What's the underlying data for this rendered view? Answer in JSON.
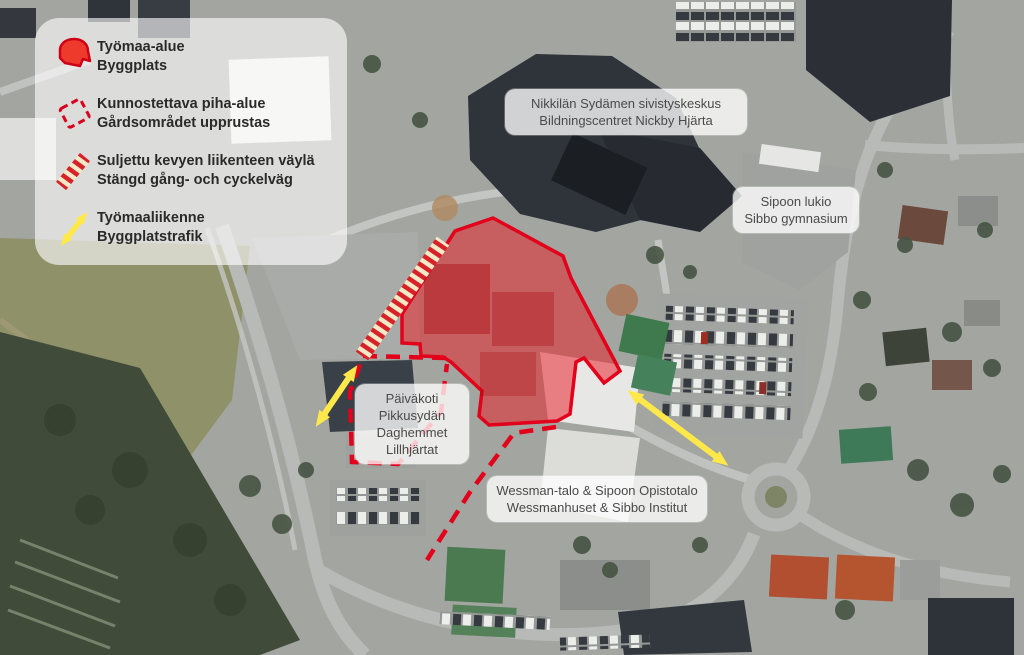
{
  "map_title": "Nickby construction site aerial map",
  "legend": {
    "items": [
      {
        "icon": "construction-area-icon",
        "line1": "Työmaa-alue",
        "line2": "Byggplats"
      },
      {
        "icon": "renovated-yard-icon",
        "line1": "Kunnostettava piha-alue",
        "line2": "Gårdsområdet upprustas"
      },
      {
        "icon": "closed-path-icon",
        "line1": "Suljettu kevyen liikenteen väylä",
        "line2": "Stängd gång- och cyckelväg"
      },
      {
        "icon": "construction-traffic-icon",
        "line1": "Työmaaliikenne",
        "line2": "Byggplatstrafik"
      }
    ]
  },
  "map_labels": {
    "sivistyskeskus": {
      "line1": "Nikkilän Sydämen sivistyskeskus",
      "line2": "Bildningscentret Nickby Hjärta"
    },
    "lukio": {
      "line1": "Sipoon lukio",
      "line2": "Sibbo gymnasium"
    },
    "paivakoti": {
      "line1": "Päiväkoti",
      "line2": "Pikkusydän",
      "line3": "Daghemmet",
      "line4": "Lillhjärtat"
    },
    "wessman": {
      "line1": "Wessman-talo & Sipoon Opistotalo",
      "line2": "Wessmanhuset & Sibbo Institut"
    }
  },
  "colors": {
    "construction_red_fill": "#ea1c24",
    "construction_red_line": "#e2001a",
    "traffic_yellow": "#ffe94a",
    "closed_path_cream": "#f3e9c6"
  }
}
